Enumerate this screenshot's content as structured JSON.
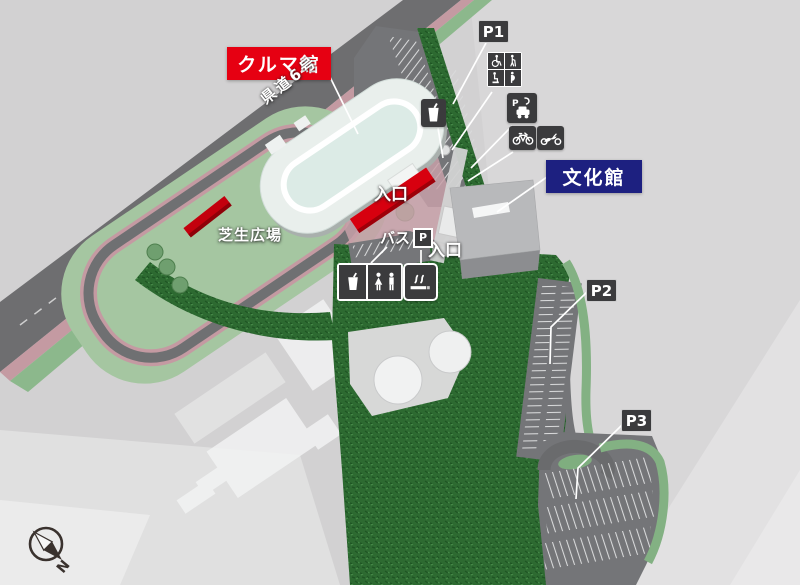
{
  "map": {
    "title_context": "facility-guide-map",
    "labels": {
      "kuruma_kan": "クルマ館",
      "bunka_kan": "文化館",
      "p1": "P1",
      "p2": "P2",
      "p3": "P3",
      "entrance_main": "入口",
      "entrance_bunka": "入口",
      "bus": "バス",
      "bus_p": "P",
      "lawn_plaza": "芝生広場",
      "prefectural_road": "県道6号",
      "compass_north": "N"
    },
    "icons": {
      "ev_label": "P",
      "list": [
        "drink-icon",
        "wheelchair-icon",
        "cane-user-icon",
        "ostomate-icon",
        "maternity-icon",
        "ev-charging-icon",
        "bicycle-icon",
        "motorcycle-icon",
        "toilet-icon",
        "smoking-area-icon",
        "compass-icon"
      ]
    },
    "colors": {
      "label_red": "#e60012",
      "label_navy": "#1d2080",
      "label_dark": "#3b3b3d",
      "road_gray": "#6e6e70",
      "sidewalk_pink": "#c49aa2",
      "green_strip": "#8cb88c",
      "lawn_green": "#a5c6a1",
      "forest_green": "#2d6a31",
      "entrance_red": "#d7000f",
      "background": "#d2d1d2"
    }
  }
}
